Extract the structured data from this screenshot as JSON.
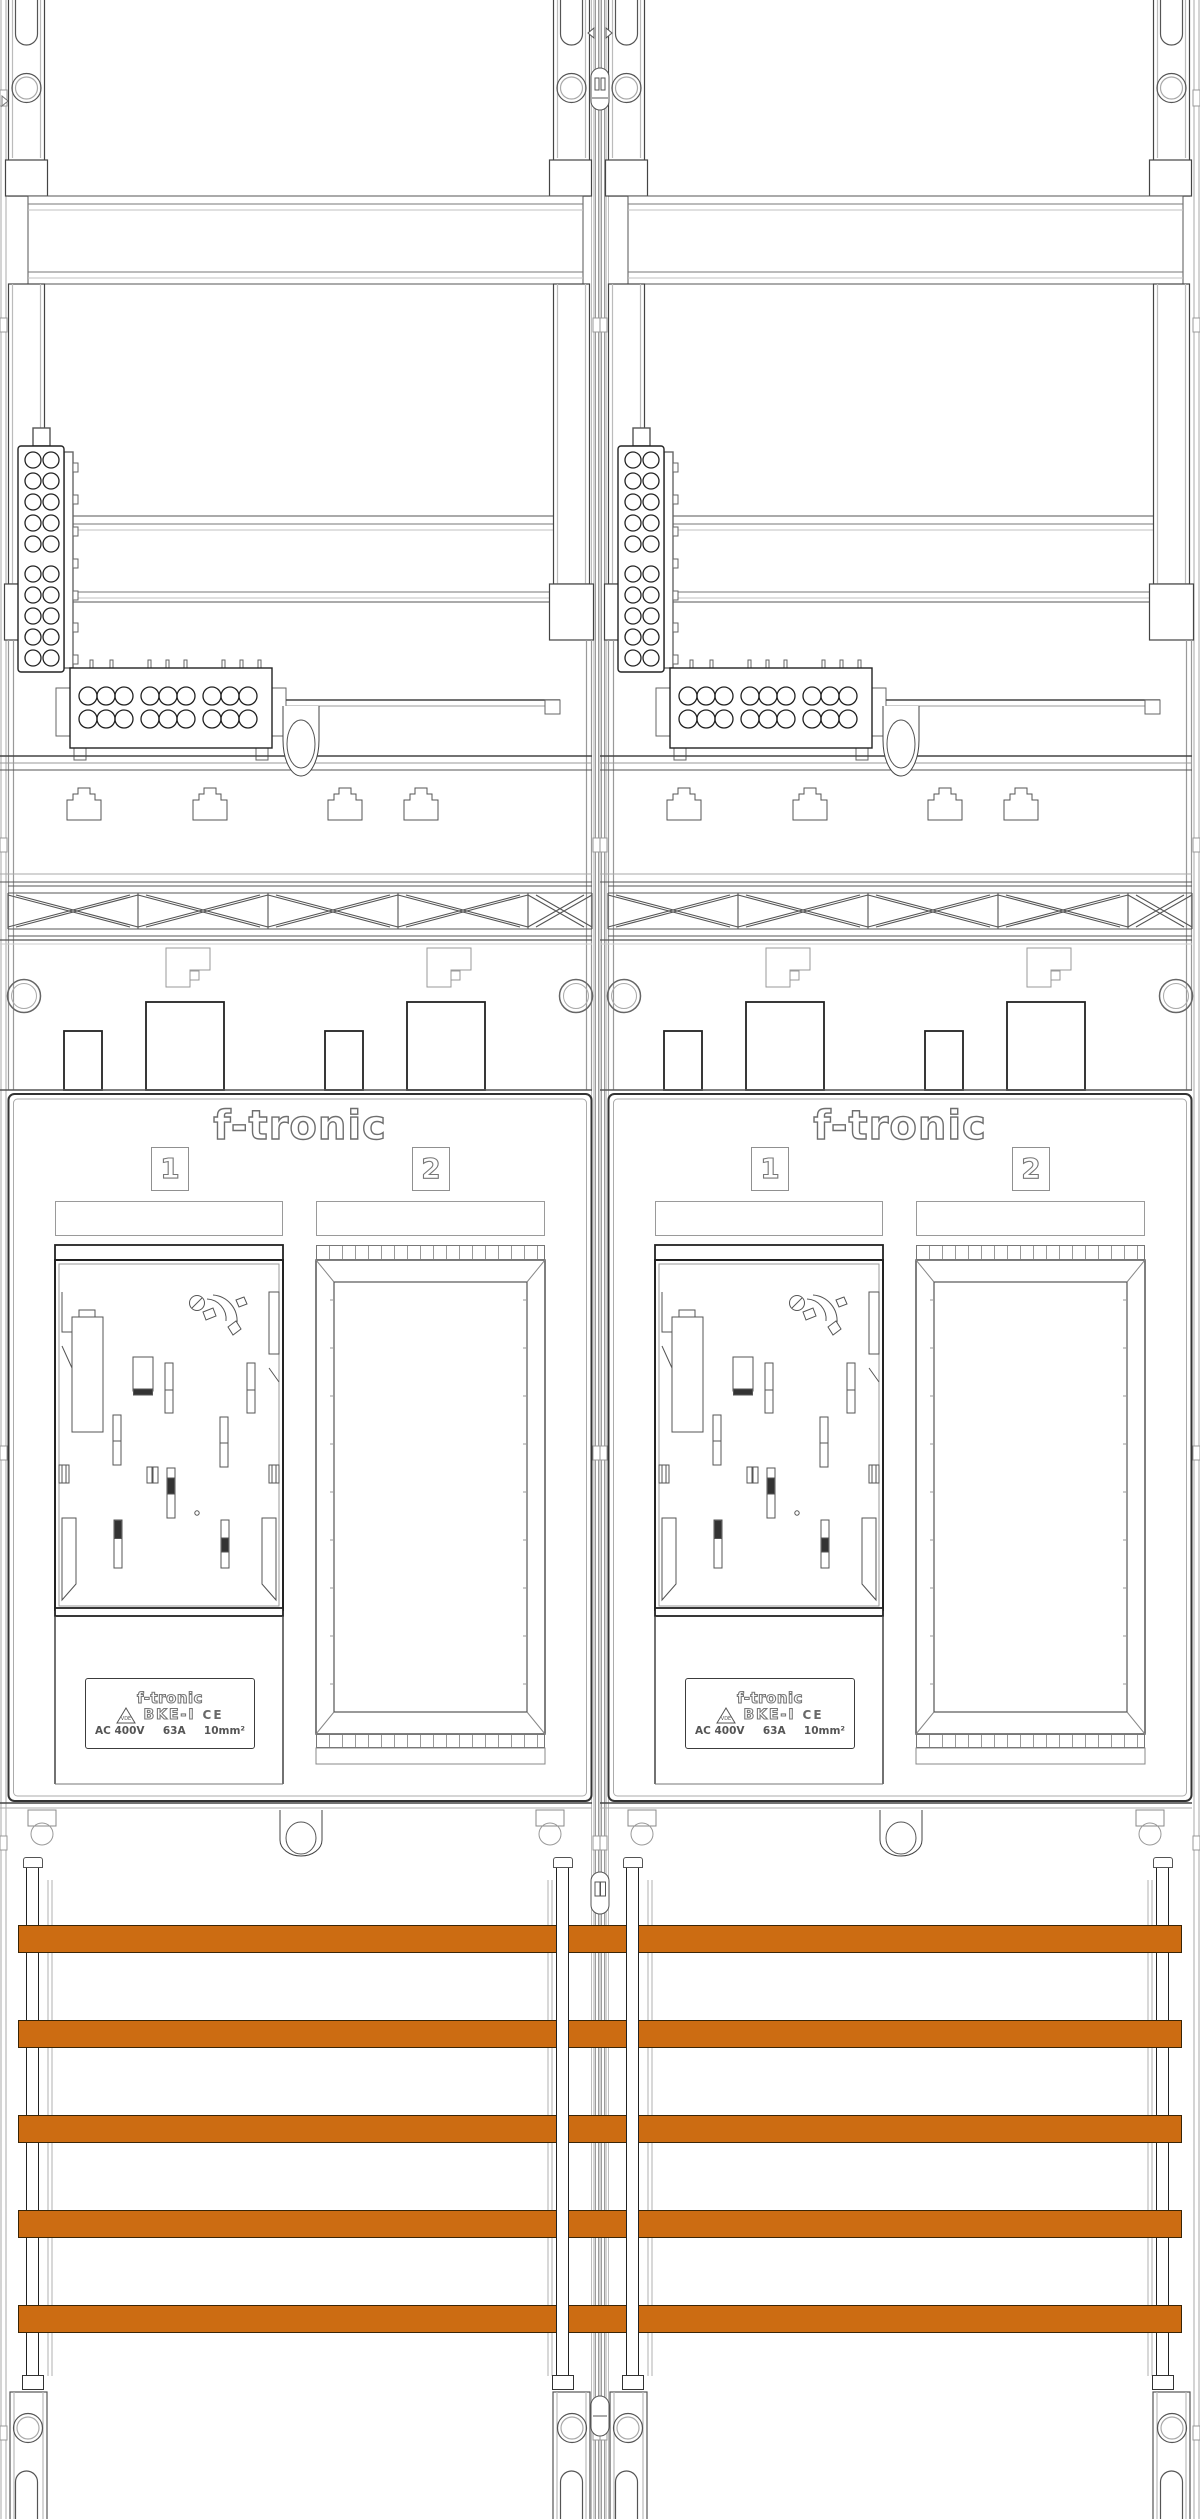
{
  "panel": {
    "brand_logo": "f-tronic",
    "field_numbers": [
      "1",
      "2"
    ],
    "meter_label": {
      "brand": "f-tronic",
      "vde_mark": "VDE",
      "model": "BKE-I",
      "ce_mark": "CE",
      "rating_voltage": "AC 400V",
      "rating_current": "63A",
      "rating_wire": "10mm²"
    }
  },
  "busbars": {
    "count": 5,
    "color": "#cc6c12"
  }
}
